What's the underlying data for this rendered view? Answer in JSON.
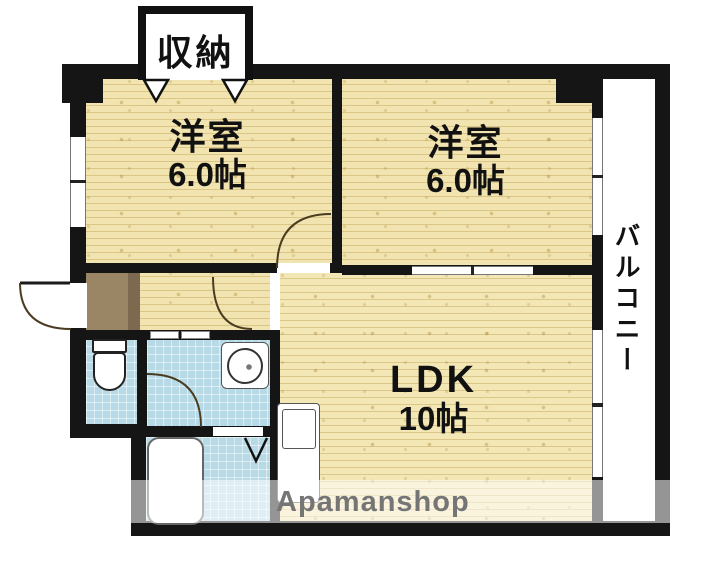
{
  "plan": {
    "closet_label": "収納",
    "rooms": [
      {
        "name": "洋室",
        "size": "6.0帖"
      },
      {
        "name": "洋室",
        "size": "6.0帖"
      },
      {
        "name": "LDK",
        "size": "10帖"
      }
    ],
    "balcony_label": "バルコニー",
    "watermark": "Apamanshop",
    "colors": {
      "wall": "#151515",
      "tatami_floor": "#f2e4b0",
      "ldk_floor": "#f3e7b6",
      "wet_area_tile": "#b7dae6",
      "entrance_floor": "#9a8565",
      "balcony_floor": "#ffffff",
      "watermark_text": "#757575"
    },
    "fixtures": {
      "toilet": "toilet-icon",
      "washbasin": "washbasin-icon",
      "bathtub": "bathtub-icon",
      "kitchen_sink": "kitchen-sink-icon",
      "entrance_door": "door-swing-arc",
      "closet_doors": "folding-door-marks",
      "bathroom_door": "folding-door-mark"
    }
  }
}
